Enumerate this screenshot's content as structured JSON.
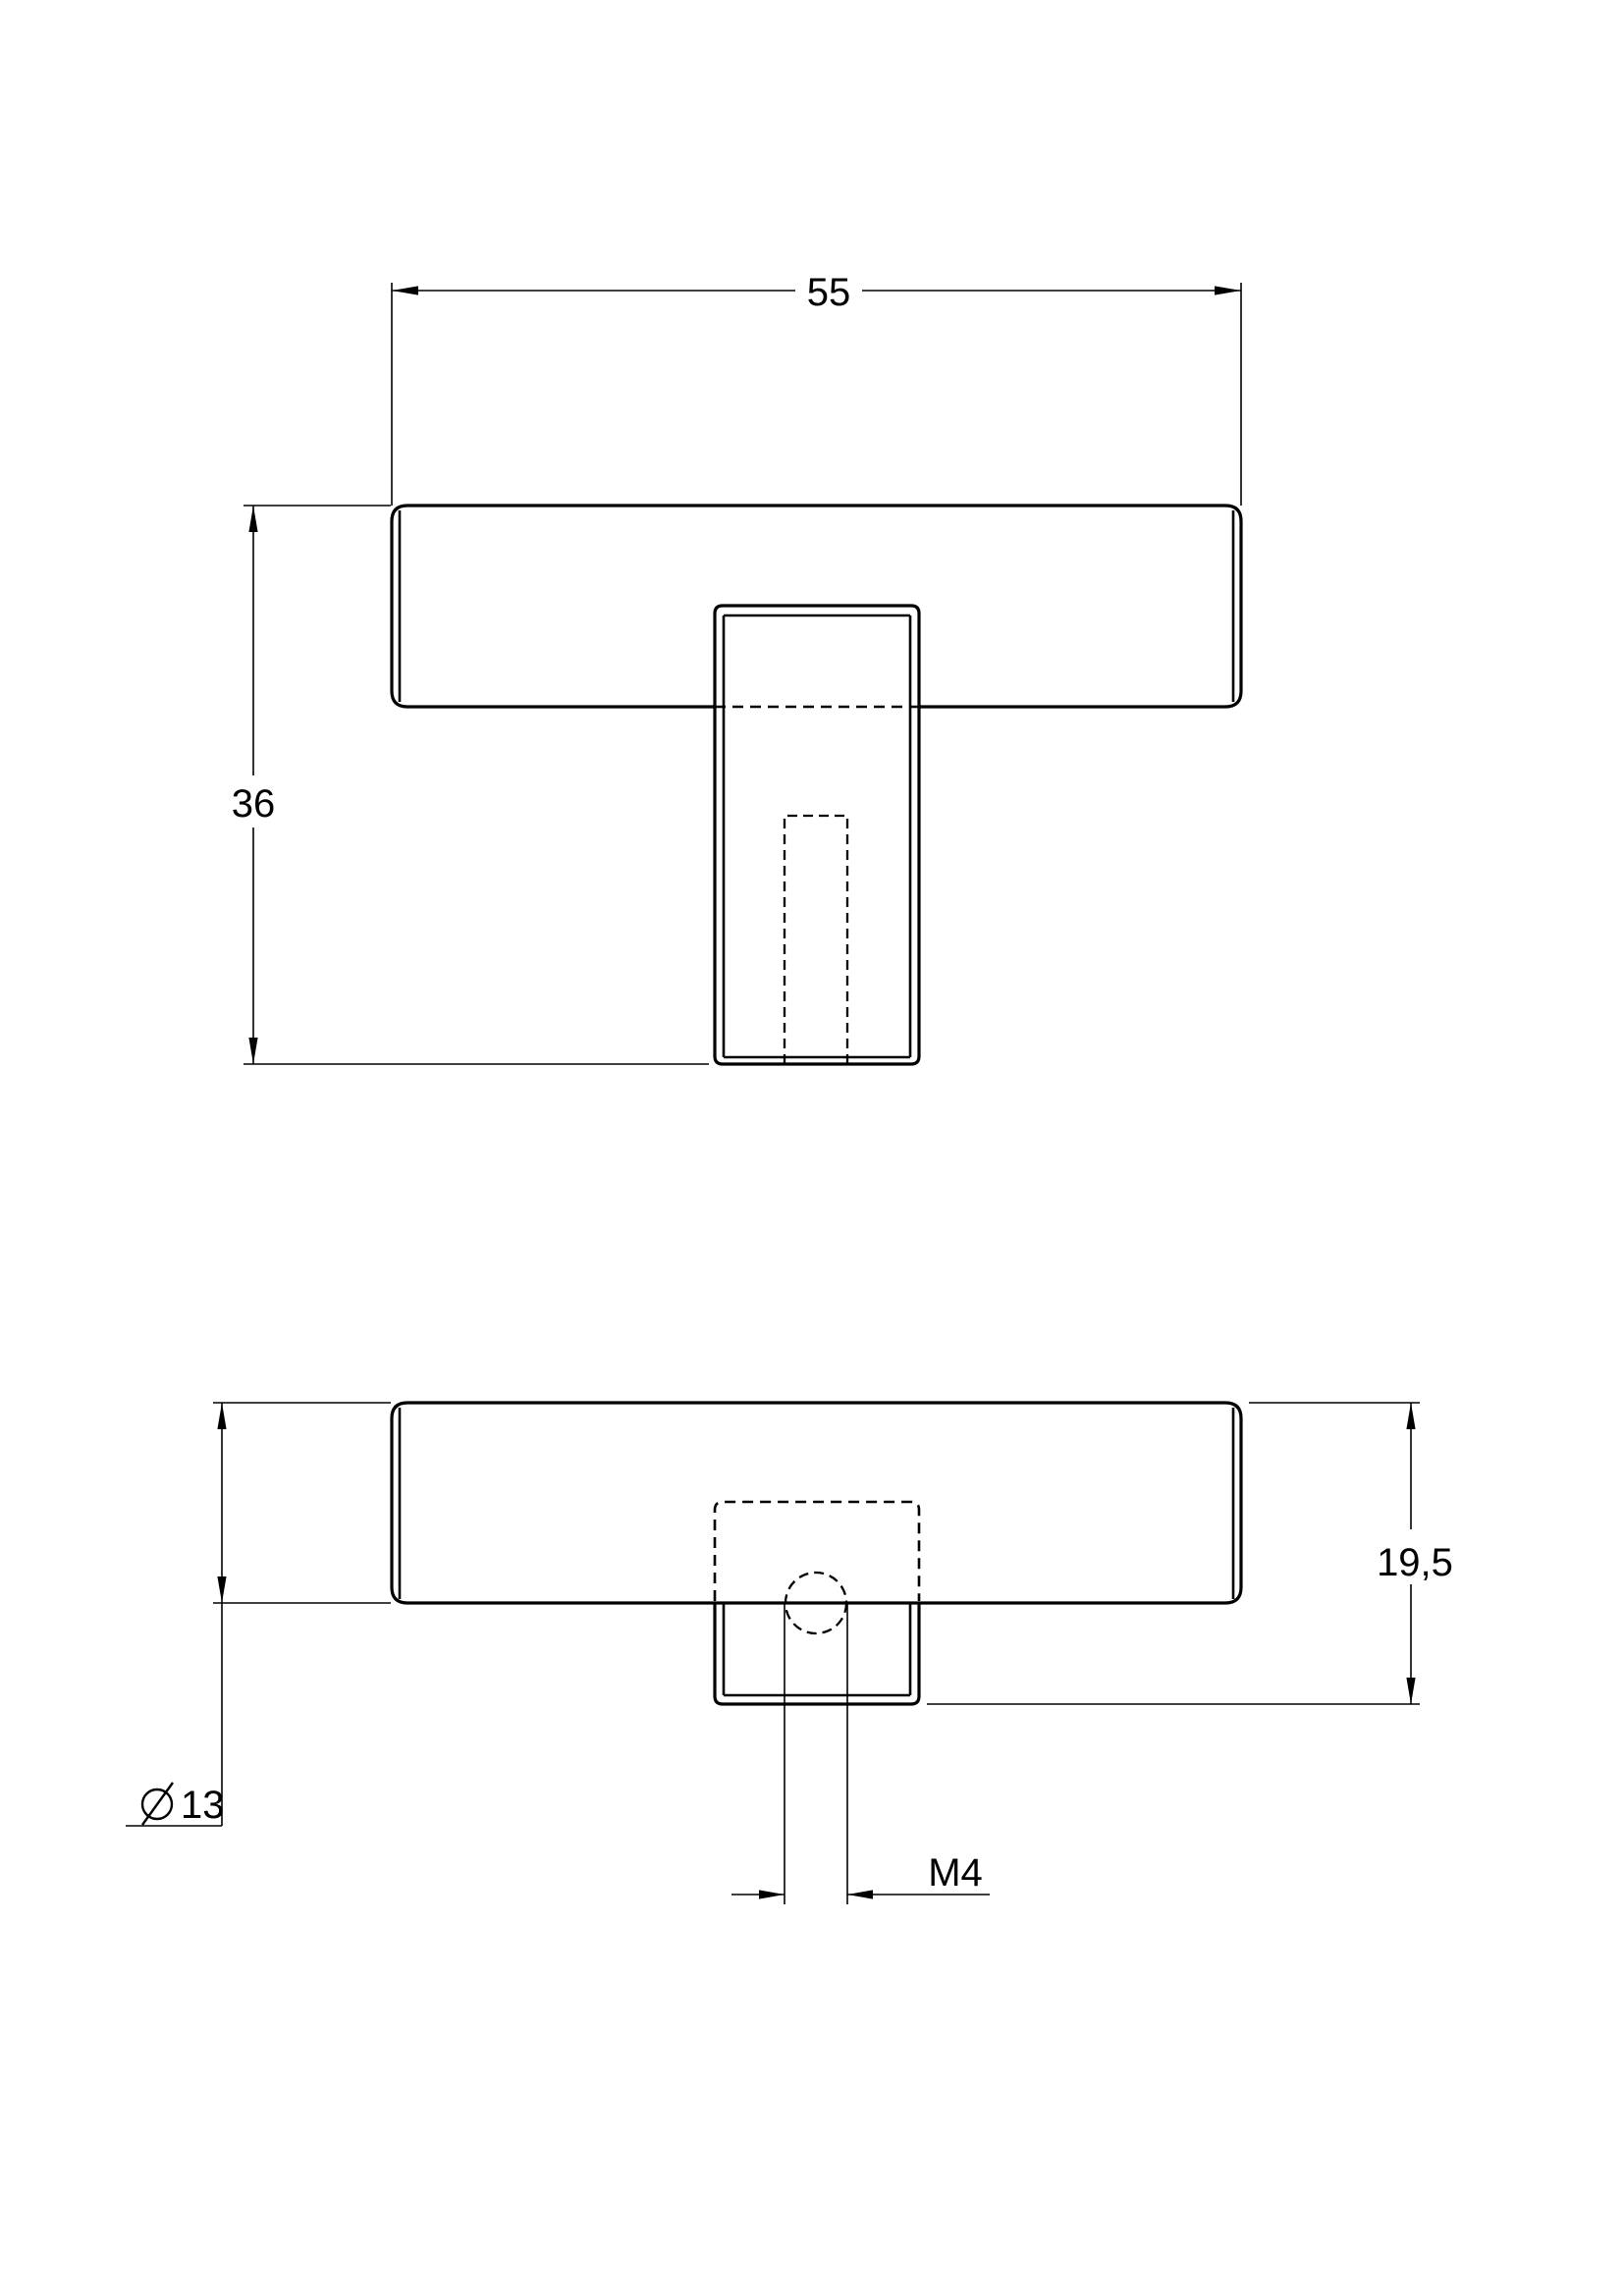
{
  "page": {
    "background_color": "#ffffff",
    "line_color": "#000000"
  },
  "drawing": {
    "type": "technical-drawing-two-views",
    "dimensions": {
      "length": {
        "value": "55"
      },
      "total_height": {
        "value": "36"
      },
      "diameter": {
        "symbol": "⌀",
        "value": "13"
      },
      "head_height": {
        "value": "19,5"
      },
      "thread": {
        "value": "M4"
      }
    }
  }
}
